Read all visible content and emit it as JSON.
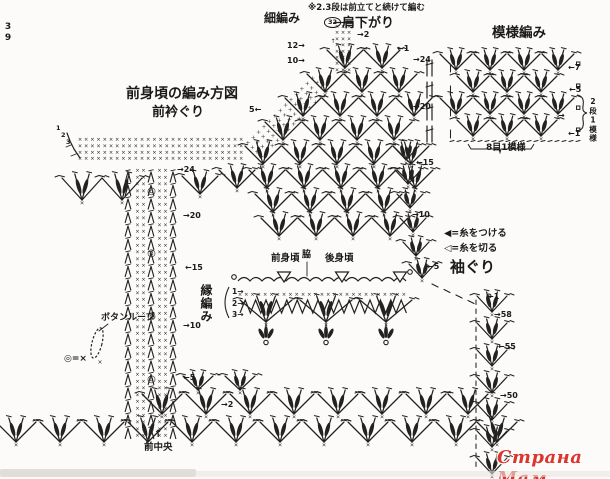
{
  "canvas": {
    "w": 610,
    "h": 479,
    "bg": "#fcfbf9",
    "ink": "#242220"
  },
  "symbols": {
    "sc": "×",
    "button": "◎",
    "up_arrow": "↑"
  },
  "watermark": {
    "text": "Страна Мам",
    "color": "#dd342c"
  },
  "groups": {
    "titles": [
      {
        "name": "page-number",
        "text": "39",
        "x": 3,
        "y": 22,
        "fs": 9,
        "b": 1,
        "vert": 1
      },
      {
        "name": "main-title",
        "text": "前身頃の編み方図",
        "x": 126,
        "y": 87,
        "fs": 14,
        "b": 1
      },
      {
        "name": "sub-title",
        "text": "前衿ぐり",
        "x": 152,
        "y": 106,
        "fs": 13,
        "b": 1
      },
      {
        "name": "swatch-title",
        "text": "模様編み",
        "x": 492,
        "y": 27,
        "fs": 13.5,
        "b": 1
      },
      {
        "name": "shoulder-title",
        "text": "肩下がり",
        "x": 342,
        "y": 17,
        "fs": 13,
        "b": 1
      },
      {
        "name": "sc-title",
        "text": "細編み",
        "x": 264,
        "y": 12,
        "fs": 12,
        "b": 1
      },
      {
        "name": "armhole-title",
        "text": "袖ぐり",
        "x": 450,
        "y": 260,
        "fs": 15,
        "b": 1
      },
      {
        "name": "edge-title",
        "text": "縁編み",
        "x": 200,
        "y": 284,
        "fs": 12,
        "b": 1,
        "vert": 1
      }
    ],
    "notes": [
      {
        "name": "band-note",
        "text": "※2.3段は前立てと続けて編む",
        "x": 308,
        "y": 4,
        "fs": 8.5,
        "b": 1
      },
      {
        "name": "swatch-repeat-width",
        "text": "8目1模様",
        "x": 486,
        "y": 144,
        "fs": 9,
        "b": 1
      },
      {
        "name": "swatch-repeat-height",
        "text": "2段1模様",
        "x": 589,
        "y": 97,
        "fs": 7.5,
        "b": 1,
        "vert": 1
      },
      {
        "name": "front-center-label",
        "text": "前中央",
        "x": 144,
        "y": 443,
        "fs": 9.5,
        "b": 1
      },
      {
        "name": "front-center-arrow",
        "text": "↑",
        "x": 154,
        "y": 430,
        "fs": 10,
        "b": 1
      },
      {
        "name": "button-loop-label",
        "text": "ボタンループ",
        "x": 101,
        "y": 314,
        "fs": 9,
        "b": 1
      },
      {
        "name": "loop-symbol-note",
        "text": "◎=×",
        "x": 64,
        "y": 355,
        "fs": 9,
        "b": 1
      },
      {
        "name": "band-stitch-count",
        "text": "32",
        "x": 324,
        "y": 17,
        "fs": 6.5,
        "b": 1,
        "circ": 1
      },
      {
        "name": "collar-row-1",
        "text": "1",
        "x": 56,
        "y": 125,
        "fs": 6.5,
        "b": 1
      },
      {
        "name": "collar-row-2",
        "text": "2",
        "x": 61,
        "y": 132,
        "fs": 6.5,
        "b": 1
      },
      {
        "name": "collar-row-3",
        "text": "3",
        "x": 66,
        "y": 139,
        "fs": 6.5,
        "b": 1
      }
    ],
    "legend": [
      {
        "name": "legend-attach-yarn",
        "text": "◀=糸をつける",
        "x": 444,
        "y": 229,
        "fs": 9.5,
        "b": 1
      },
      {
        "name": "legend-cut-yarn",
        "text": "◁=糸を切る",
        "x": 444,
        "y": 244,
        "fs": 9.5,
        "b": 1
      }
    ],
    "detail_labels": [
      {
        "name": "front-body-label",
        "text": "前身頃",
        "x": 271,
        "y": 254,
        "fs": 9.5,
        "b": 1
      },
      {
        "name": "side-label",
        "text": "脇",
        "x": 302,
        "y": 251,
        "fs": 9,
        "b": 1
      },
      {
        "name": "back-body-label",
        "text": "後身頃",
        "x": 325,
        "y": 254,
        "fs": 9.5,
        "b": 1
      },
      {
        "name": "edge-row-1",
        "text": "1→",
        "x": 232,
        "y": 288,
        "fs": 7.5,
        "b": 1
      },
      {
        "name": "edge-row-2",
        "text": "2→",
        "x": 232,
        "y": 300,
        "fs": 7.5,
        "b": 1
      },
      {
        "name": "edge-row-3",
        "text": "3→",
        "x": 232,
        "y": 311,
        "fs": 7.5,
        "b": 1
      }
    ],
    "row_marks": [
      {
        "name": "row-mark-band-12",
        "text": "12→",
        "x": 287,
        "y": 42,
        "fs": 8,
        "b": 1
      },
      {
        "name": "row-mark-band-10",
        "text": "10→",
        "x": 287,
        "y": 57,
        "fs": 8,
        "b": 1
      },
      {
        "name": "row-mark-band-5",
        "text": "5←",
        "x": 249,
        "y": 106,
        "fs": 8,
        "b": 1
      },
      {
        "name": "row-mark-shoulder-2",
        "text": "→2",
        "x": 357,
        "y": 31,
        "fs": 8,
        "b": 1
      },
      {
        "name": "row-mark-shoulder-1",
        "text": "←1",
        "x": 397,
        "y": 45,
        "fs": 8,
        "b": 1
      },
      {
        "name": "row-mark-right-24",
        "text": "→24",
        "x": 413,
        "y": 56,
        "fs": 8,
        "b": 1
      },
      {
        "name": "row-mark-right-20",
        "text": "→20",
        "x": 413,
        "y": 103,
        "fs": 8,
        "b": 1
      },
      {
        "name": "row-mark-right-15",
        "text": "←15",
        "x": 416,
        "y": 159,
        "fs": 8,
        "b": 1
      },
      {
        "name": "row-mark-right-10",
        "text": "→10",
        "x": 412,
        "y": 211,
        "fs": 8,
        "b": 1
      },
      {
        "name": "row-mark-right-5",
        "text": "←5",
        "x": 427,
        "y": 263,
        "fs": 8,
        "b": 1
      },
      {
        "name": "row-mark-left-24",
        "text": "→24",
        "x": 177,
        "y": 166,
        "fs": 8,
        "b": 1
      },
      {
        "name": "row-mark-left-20",
        "text": "→20",
        "x": 183,
        "y": 212,
        "fs": 8,
        "b": 1
      },
      {
        "name": "row-mark-left-15",
        "text": "←15",
        "x": 185,
        "y": 264,
        "fs": 8,
        "b": 1
      },
      {
        "name": "row-mark-left-10",
        "text": "→10",
        "x": 183,
        "y": 322,
        "fs": 8,
        "b": 1
      },
      {
        "name": "row-mark-left-5",
        "text": "←5",
        "x": 183,
        "y": 374,
        "fs": 8,
        "b": 1
      },
      {
        "name": "row-mark-left-2",
        "text": "→2",
        "x": 221,
        "y": 401,
        "fs": 8,
        "b": 1
      },
      {
        "name": "row-mark-side-1",
        "text": "←1",
        "x": 487,
        "y": 293,
        "fs": 8,
        "b": 1
      },
      {
        "name": "row-mark-side-58",
        "text": "→58",
        "x": 494,
        "y": 311,
        "fs": 8,
        "b": 1
      },
      {
        "name": "row-mark-side-55",
        "text": "←55",
        "x": 498,
        "y": 343,
        "fs": 8,
        "b": 1
      },
      {
        "name": "row-mark-side-50",
        "text": "→50",
        "x": 500,
        "y": 392,
        "fs": 8,
        "b": 1
      },
      {
        "name": "row-mark-swatch-7",
        "text": "←7",
        "x": 568,
        "y": 64,
        "fs": 8,
        "b": 1
      },
      {
        "name": "row-mark-swatch-5",
        "text": "←5",
        "x": 569,
        "y": 86,
        "fs": 8,
        "b": 1
      },
      {
        "name": "row-mark-swatch-arrow",
        "text": "→",
        "x": 558,
        "y": 112,
        "fs": 8,
        "b": 1
      },
      {
        "name": "row-mark-swatch-1",
        "text": "←1",
        "x": 568,
        "y": 130,
        "fs": 8,
        "b": 1
      }
    ]
  }
}
